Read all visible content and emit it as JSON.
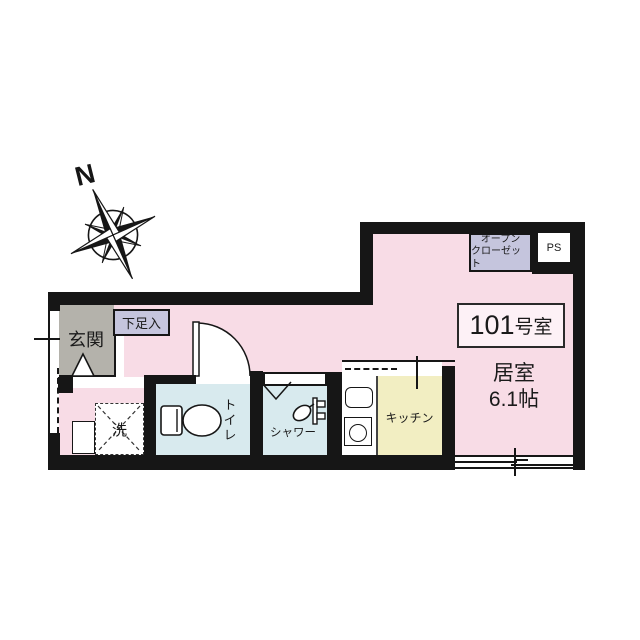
{
  "colors": {
    "wall": "#161616",
    "ink": "#1a1a1a",
    "floor": "#f8dce6",
    "entrance": "#b4b2ab",
    "storage": "#c5c5dd",
    "wet": "#d8eaee",
    "kitchen": "#f2eec2",
    "paper": "#ffffff",
    "roombox": "#fdf1f6"
  },
  "plan": {
    "compass": {
      "label": "N"
    },
    "room_number": {
      "number": "101",
      "suffix": "号室"
    },
    "living": {
      "name": "居室",
      "size": "6.1帖"
    },
    "entrance": {
      "label": "玄関"
    },
    "shoe_storage": {
      "label": "下足入"
    },
    "washer": {
      "label": "洗"
    },
    "toilet": {
      "label": "トイレ"
    },
    "shower": {
      "label": "シャワー"
    },
    "kitchen": {
      "label": "キッチン"
    },
    "open_closet": {
      "line1": "オープン",
      "line2": "クローゼット"
    },
    "pipe_space": {
      "label": "PS"
    }
  }
}
